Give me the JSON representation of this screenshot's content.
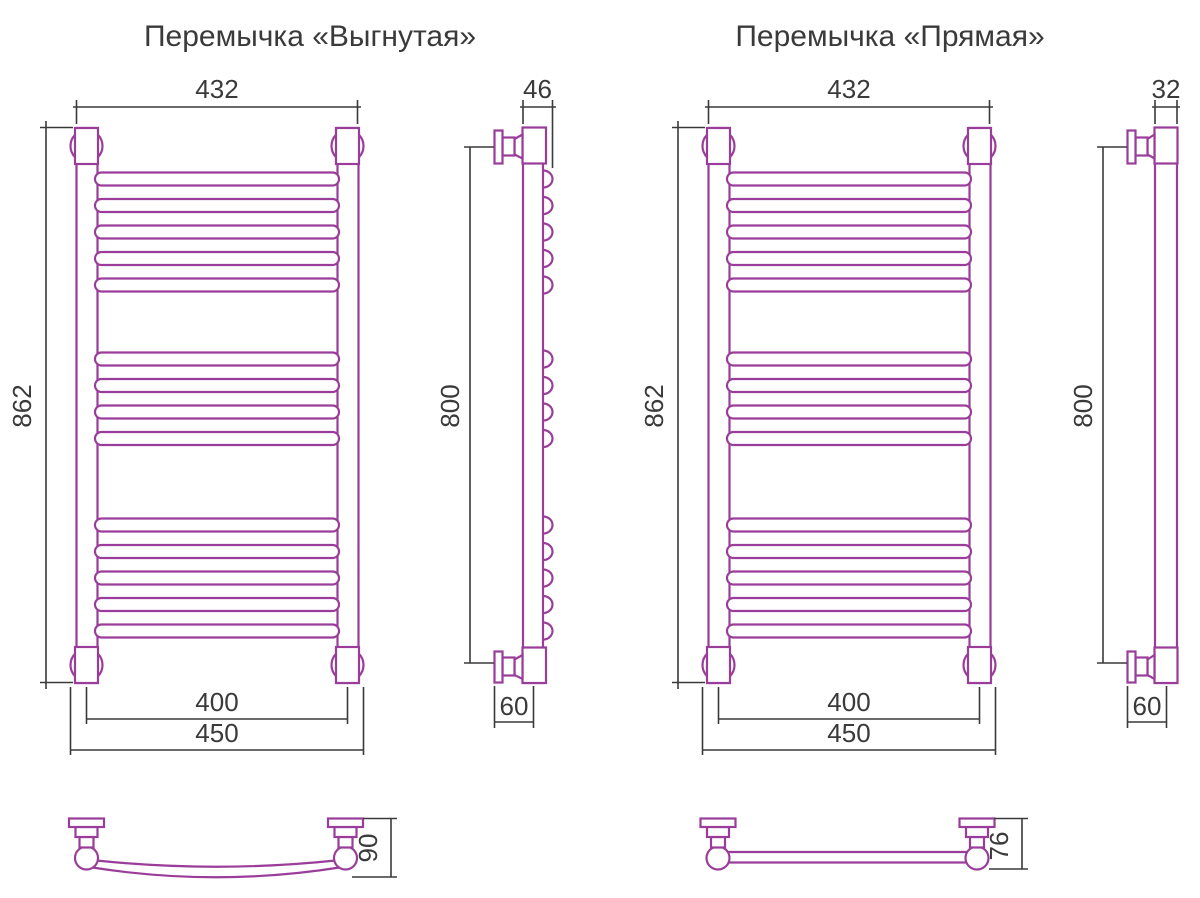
{
  "titles": {
    "curved": "Перемычка «Выгнутая»",
    "straight": "Перемычка «Прямая»"
  },
  "dimensions": {
    "curved": {
      "top_width": "432",
      "height": "862",
      "mount_spacing": "400",
      "overall_width": "450",
      "side_depth": "46",
      "mount_height": "800",
      "wall_offset": "60",
      "bar_depth": "90"
    },
    "straight": {
      "top_width": "432",
      "height": "862",
      "mount_spacing": "400",
      "overall_width": "450",
      "side_depth": "32",
      "mount_height": "800",
      "wall_offset": "60",
      "bar_depth": "76"
    }
  },
  "colors": {
    "outline": "#9a3d9a",
    "dimension": "#3a3a3a"
  }
}
